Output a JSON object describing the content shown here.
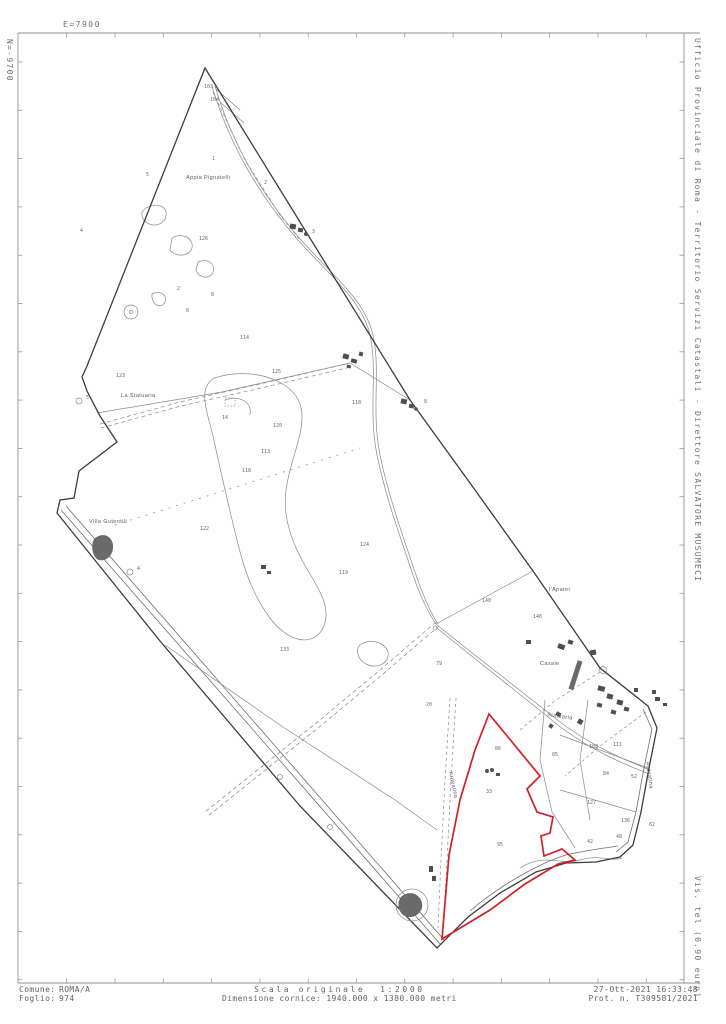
{
  "sheet": {
    "colors": {
      "paper": "#fefefe",
      "frame": "#8f8f8f",
      "boundary": "#3c3c3c",
      "minor_lines": "#8a8a8a",
      "buildings": "#4f4f4f",
      "highlight_red": "#d02028"
    }
  },
  "margins": {
    "top_coord_label": "E=7900",
    "left_coord_label": "N=-9700",
    "right_header": "Ufficio Provinciale di Roma - Territorio Servizi Catastali - Direttore SALVATORE MUSUMECI",
    "right_footer": "Vis. tel (0.90 euro)"
  },
  "footer": {
    "comune_label": "Comune:",
    "comune_value": "ROMA/A",
    "foglio_label": "Foglio:",
    "foglio_value": "974",
    "scala": "Scala originale  1:2000",
    "dimensione": "Dimensione cornice: 1940.000 x 1380.000 metri",
    "datetime": "27-Ott-2021 16:33:48",
    "protocollo": "Prot. n. T309581/2021"
  },
  "map": {
    "red_parcel": {
      "stroke": "#d02028"
    },
    "toponyms": [
      {
        "text": "Appia Pignatelli",
        "x": 186,
        "y": 179,
        "rotate": 0
      },
      {
        "text": "La Statuaria",
        "x": 121,
        "y": 397,
        "rotate": 0
      },
      {
        "text": "Villa Gutentili",
        "x": 89,
        "y": 523,
        "rotate": 0
      },
      {
        "text": "l'Apater",
        "x": 549,
        "y": 591,
        "rotate": 0
      },
      {
        "text": "Casale",
        "x": 540,
        "y": 665,
        "rotate": 0
      },
      {
        "text": "Statuaria",
        "x": 547,
        "y": 716,
        "rotate": 8
      },
      {
        "text": "Ardeatina",
        "x": 449,
        "y": 772,
        "rotate": 78
      },
      {
        "text": "Ardeatina",
        "x": 646,
        "y": 762,
        "rotate": 82
      }
    ],
    "parcel_numbers": [
      {
        "n": "103",
        "x": 204,
        "y": 88
      },
      {
        "n": "104",
        "x": 210,
        "y": 101
      },
      {
        "n": "1",
        "x": 212,
        "y": 160
      },
      {
        "n": "2",
        "x": 264,
        "y": 184
      },
      {
        "n": "5",
        "x": 146,
        "y": 176
      },
      {
        "n": "4",
        "x": 80,
        "y": 232
      },
      {
        "n": "126",
        "x": 199,
        "y": 240
      },
      {
        "n": "2",
        "x": 177,
        "y": 290
      },
      {
        "n": "8",
        "x": 211,
        "y": 296
      },
      {
        "n": "6",
        "x": 186,
        "y": 312
      },
      {
        "n": "3",
        "x": 312,
        "y": 233
      },
      {
        "n": "123",
        "x": 116,
        "y": 377
      },
      {
        "n": "114",
        "x": 240,
        "y": 339
      },
      {
        "n": "118",
        "x": 352,
        "y": 404
      },
      {
        "n": "125",
        "x": 272,
        "y": 373
      },
      {
        "n": "14",
        "x": 222,
        "y": 419
      },
      {
        "n": "120",
        "x": 273,
        "y": 427
      },
      {
        "n": "113",
        "x": 261,
        "y": 453
      },
      {
        "n": "118",
        "x": 242,
        "y": 472
      },
      {
        "n": "5",
        "x": 86,
        "y": 399
      },
      {
        "n": "4",
        "x": 137,
        "y": 570
      },
      {
        "n": "8",
        "x": 424,
        "y": 403
      },
      {
        "n": "122",
        "x": 200,
        "y": 530
      },
      {
        "n": "124",
        "x": 360,
        "y": 546
      },
      {
        "n": "119",
        "x": 339,
        "y": 574
      },
      {
        "n": "133",
        "x": 280,
        "y": 651
      },
      {
        "n": "79",
        "x": 436,
        "y": 665
      },
      {
        "n": "140",
        "x": 482,
        "y": 602
      },
      {
        "n": "146",
        "x": 533,
        "y": 618
      },
      {
        "n": "20",
        "x": 426,
        "y": 706
      },
      {
        "n": "86",
        "x": 495,
        "y": 750
      },
      {
        "n": "33",
        "x": 486,
        "y": 793
      },
      {
        "n": "95",
        "x": 497,
        "y": 846
      },
      {
        "n": "85",
        "x": 552,
        "y": 756
      },
      {
        "n": "109",
        "x": 589,
        "y": 748
      },
      {
        "n": "111",
        "x": 613,
        "y": 746
      },
      {
        "n": "84",
        "x": 603,
        "y": 775
      },
      {
        "n": "52",
        "x": 631,
        "y": 778
      },
      {
        "n": "127",
        "x": 587,
        "y": 804
      },
      {
        "n": "136",
        "x": 621,
        "y": 822
      },
      {
        "n": "48",
        "x": 616,
        "y": 838
      },
      {
        "n": "42",
        "x": 587,
        "y": 843
      },
      {
        "n": "62",
        "x": 649,
        "y": 826
      }
    ]
  }
}
